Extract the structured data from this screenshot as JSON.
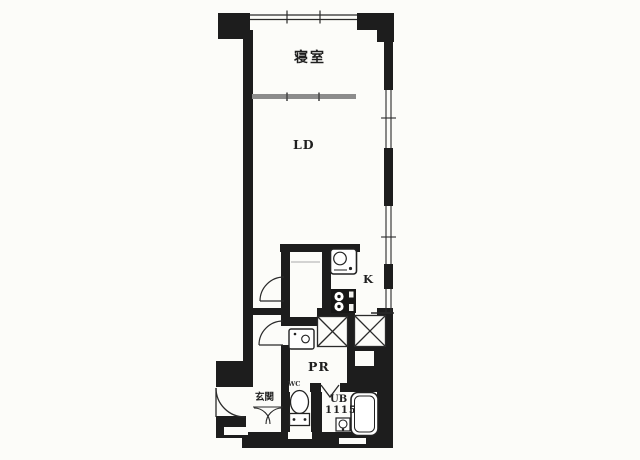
{
  "plan": {
    "type": "apartment-floor-plan",
    "colors": {
      "wall": "#1d1d1d",
      "partition": "#8c8c8c",
      "paper": "#fcfcf9",
      "line": "#2a2a2a"
    },
    "rooms": {
      "bedroom": {
        "label": "寝室"
      },
      "living_dining": {
        "label": "LD"
      },
      "kitchen": {
        "label": "K"
      },
      "powder_room": {
        "label": "PR"
      },
      "entrance": {
        "label": "玄関"
      },
      "water_closet": {
        "label": "WC"
      },
      "unit_bath": {
        "label": "UB",
        "size_code": "1115"
      }
    },
    "fixtures": [
      "kitchen-sink",
      "two-burner-stove",
      "washbasin",
      "toilet",
      "bathtub",
      "bath-washbasin",
      "pipe-space-x2",
      "shoe-cabinet"
    ],
    "openings": [
      "top-balcony-window",
      "right-wall-windows-x3",
      "entrance-outswing-door",
      "corridor-door",
      "powder-room-door",
      "unit-bath-folding-door"
    ]
  }
}
